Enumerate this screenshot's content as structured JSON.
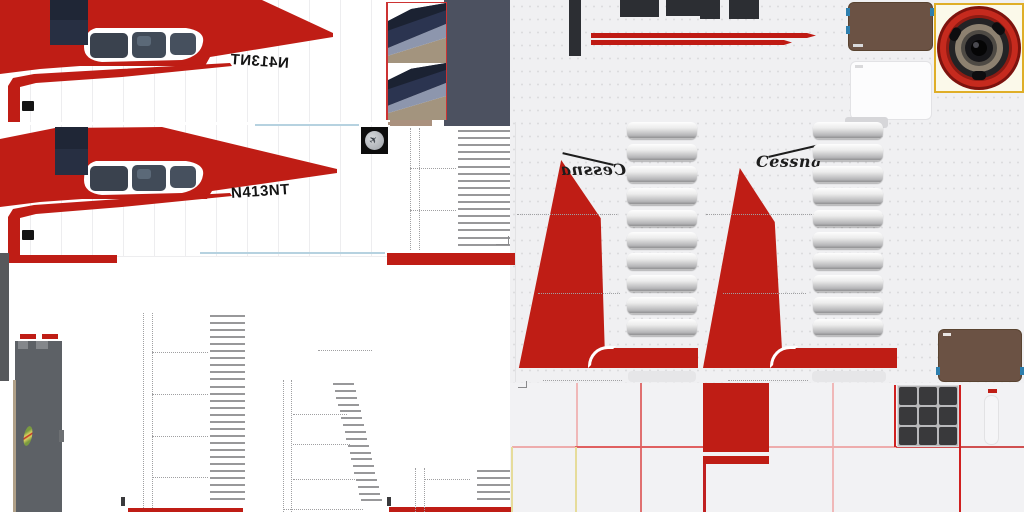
{
  "aircraft": {
    "registration": "N413NT",
    "brand": "Cessna"
  },
  "colors": {
    "livery_red": "#bf1d15",
    "fuselage_white": "#ffffff",
    "panel_gray": "#f0f0f2",
    "slate_gray": "#4c5160",
    "interior_brown": "#6b5244",
    "cowl_dark": "#2c2e33",
    "engine_ring_red": "#c62a1e",
    "engine_box_border_yellow": "#dfae28",
    "window_tint": "#3a424e",
    "gear_gray": "#5d6166",
    "cut_line_pink": "#eeacac",
    "cut_line_yellow": "#e6dc9a"
  },
  "icons": {
    "manufacturer_logo": "airplane-icon"
  }
}
